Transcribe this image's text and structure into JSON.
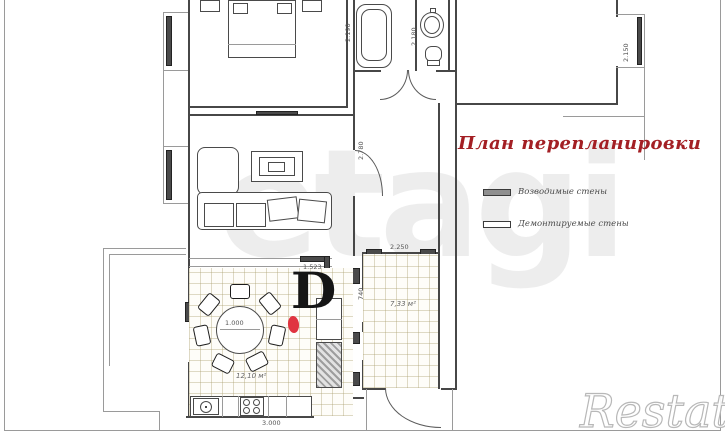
{
  "title": "План перепланировки",
  "legend": {
    "erected": "Возводимые стены",
    "demolished": "Демонтируемые стены"
  },
  "watermark_center": "etagi",
  "watermark_corner": "Restate",
  "marks": {
    "d": "D"
  },
  "dims": {
    "table": "1.000",
    "kitchen_width": "3.000",
    "kitchen_area": "12,10 м²",
    "hall_area": "7,33 м²",
    "hall_width": "2.250",
    "passage": "1.523",
    "bath_depth": "2.190",
    "wc_depth": "2.180",
    "bedroom_niche": "2.150",
    "living_side": "2.780",
    "corridor": "740"
  },
  "colors": {
    "accent_red": "#a31f24",
    "highlight_red": "#e03440",
    "wall": "#474747",
    "tile_line": "#c9bd94"
  }
}
